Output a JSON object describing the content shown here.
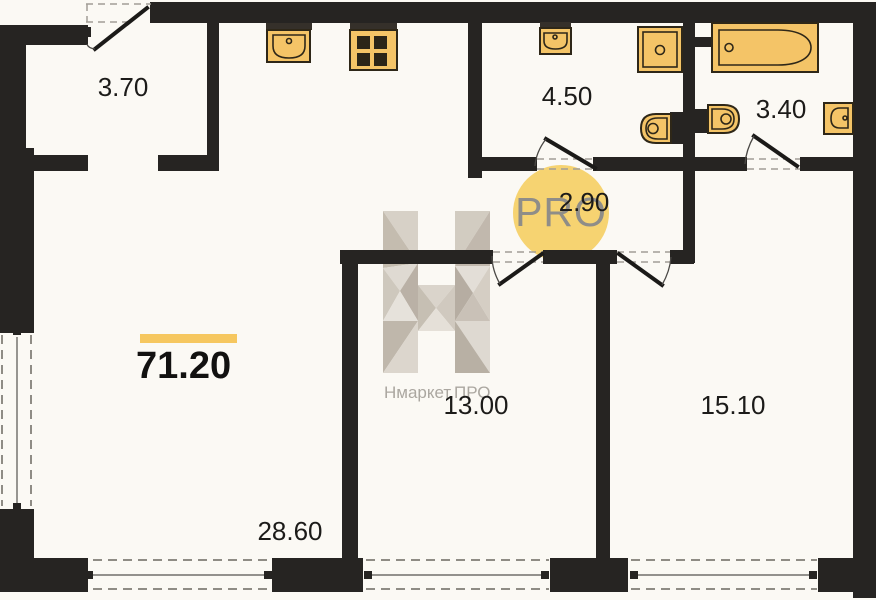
{
  "plan": {
    "total_area": "71.20",
    "rooms": [
      {
        "name": "entrance-hall",
        "area": "3.70"
      },
      {
        "name": "bathroom-large",
        "area": "4.50"
      },
      {
        "name": "bathroom-small",
        "area": "3.40"
      },
      {
        "name": "corridor",
        "area": "2.90"
      },
      {
        "name": "bedroom-left",
        "area": "13.00"
      },
      {
        "name": "bedroom-right",
        "area": "15.10"
      },
      {
        "name": "living-kitchen",
        "area": "28.60"
      }
    ],
    "fixtures": [
      "kitchen-sink",
      "stove",
      "washbasin",
      "shower-cabin",
      "toilet",
      "bathtub",
      "toilet",
      "washbasin"
    ],
    "colors": {
      "background": "#FBF9F4",
      "wall": "#262422",
      "fixture_fill": "#F4C467",
      "fixture_stroke": "#2E2718",
      "accent_bar": "#F6C75F",
      "watermark_circle": "#F5D169"
    }
  },
  "watermark": {
    "brand": "Нмаркет.ПРО",
    "badge": "PRO"
  }
}
